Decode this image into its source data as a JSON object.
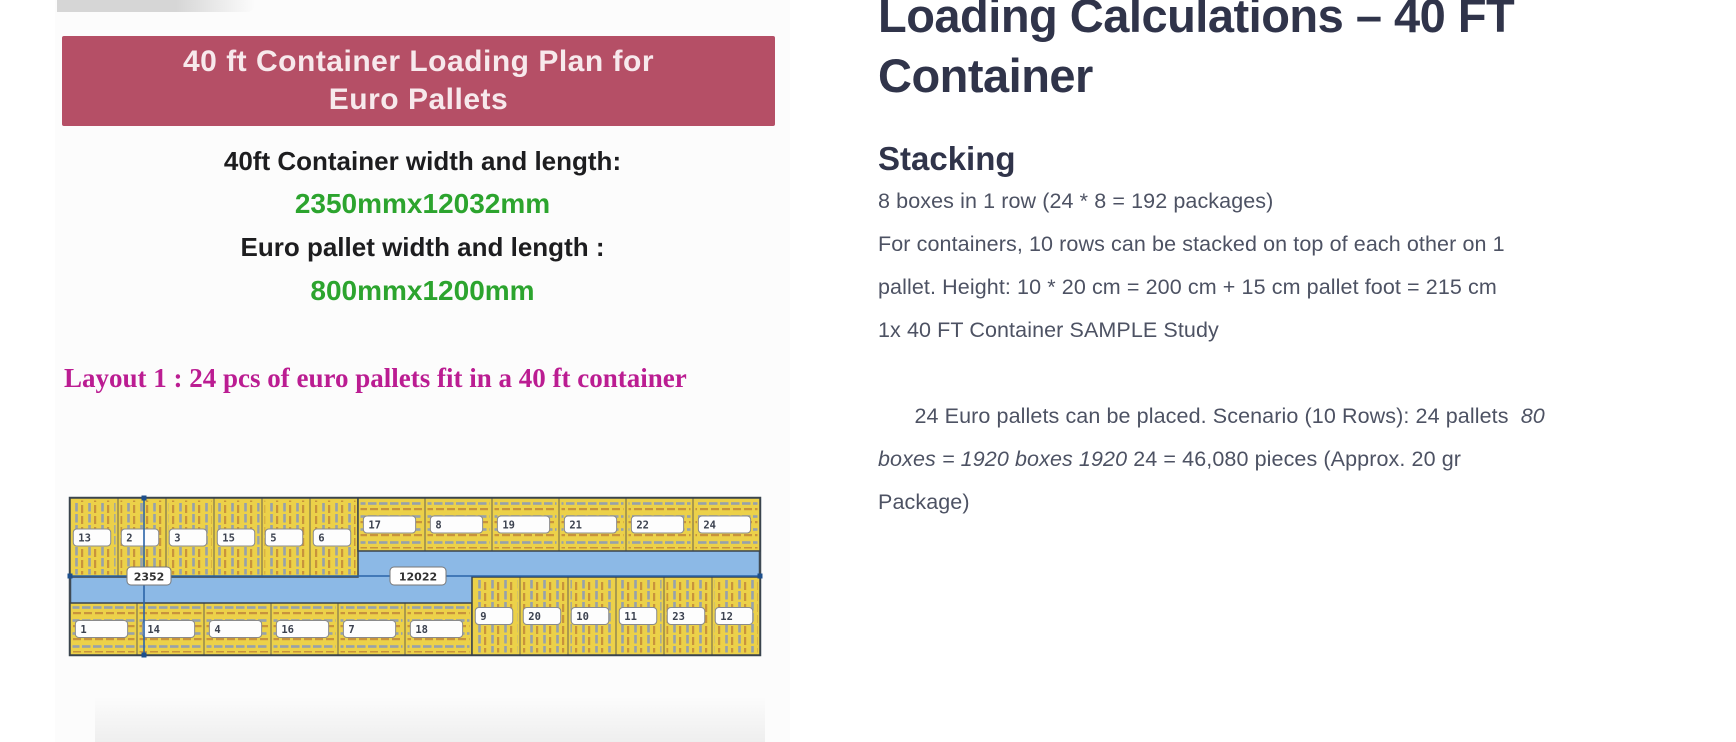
{
  "figure": {
    "banner": {
      "title": "40 ft Container Loading Plan for\nEuro Pallets",
      "bg_color": "#b54f66",
      "text_color": "#f7e9ec"
    },
    "specs": [
      {
        "label": "40ft Container width and length:",
        "value": "2350mmx12032mm"
      },
      {
        "label": "Euro pallet width and length :",
        "value": "800mmx1200mm"
      }
    ],
    "label_color": "#1d1d1f",
    "value_color": "#2ca42e",
    "caption": "Layout 1 : 24 pcs of euro pallets fit in a 40 ft container",
    "caption_color": "#bb1d92",
    "diagram": {
      "height_label": "2352",
      "width_label": "12022",
      "container_fill": "#8cb9e6",
      "container_stroke": "#3f4a55",
      "pallet_yellow": "#ecd149",
      "stripe_gray": "#96a1ac",
      "stripe_orange": "#c8933c",
      "dimension_line_color": "#2a64a8",
      "groups": [
        {
          "name": "top-left",
          "stripes": "vertical",
          "labels": [
            "13",
            "2",
            "3",
            "15",
            "5",
            "6"
          ]
        },
        {
          "name": "top-right",
          "stripes": "horizontal",
          "labels": [
            "17",
            "8",
            "19",
            "21",
            "22",
            "24"
          ]
        },
        {
          "name": "bottom-left",
          "stripes": "horizontal",
          "labels": [
            "1",
            "14",
            "4",
            "16",
            "7",
            "18"
          ]
        },
        {
          "name": "bottom-right",
          "stripes": "vertical",
          "labels": [
            "9",
            "20",
            "10",
            "11",
            "23",
            "12"
          ]
        }
      ]
    }
  },
  "article": {
    "title": "Loading Calculations – 40 FT\nContainer",
    "title_color": "#30344a",
    "body_color": "#4d5263",
    "section_heading": "Stacking",
    "p1": "8 boxes in 1 row (24 * 8 = 192 packages)",
    "p2": "For containers, 10 rows can be stacked on top of each other on 1\npallet. Height: 10 * 20 cm = 200 cm + 15 cm pallet foot = 215 cm",
    "p3": "1x 40 FT Container SAMPLE Study",
    "p4": {
      "pre": "24 Euro pallets can be placed. Scenario (10 Rows): 24 pallets  ",
      "italic": "80\nboxes = 1920 boxes 1920",
      "post": " 24 = 46,080 pieces (Approx. 20 gr\nPackage)"
    }
  }
}
